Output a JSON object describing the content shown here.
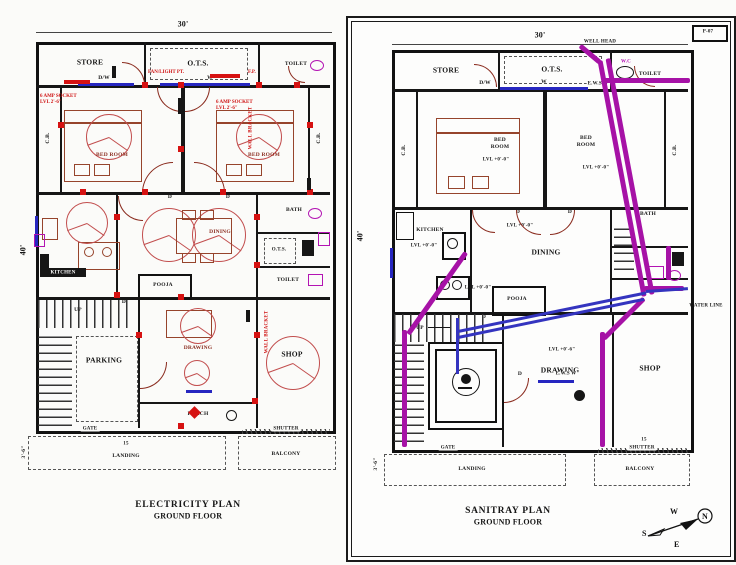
{
  "left_plan": {
    "title_line1": "ELECTRICITY PLAN",
    "title_line2": "GROUND FLOOR",
    "dim_top": "30'",
    "dim_side": "40'",
    "dim_bottom": "3'-6\"",
    "rooms": {
      "store": "STORE",
      "ots": "O.T.S.",
      "toilet_top": "TOILET",
      "bed_left": "BED ROOM",
      "bed_right": "BED ROOM",
      "cb_left": "C.B.",
      "cb_right": "C.B.",
      "kitchen": "KITCHEN",
      "dining": "DINING",
      "bath": "BATH",
      "ots_small": "O.T.S.",
      "toilet_mid": "TOILET",
      "pooja": "POOJA",
      "parking": "PARKING",
      "drawing_room": "DRAWING",
      "porch": "PORCH",
      "shop": "SHOP",
      "landing": "LANDING",
      "balcony": "BALCONY"
    },
    "tags": {
      "up": "UP",
      "gate": "GATE",
      "shutter": "SHUTTER",
      "dw": "D/W",
      "w": "W",
      "d": "D",
      "landing_width": "15"
    },
    "notes": {
      "fan_light": "FAN/LIGHT PT.",
      "fp": "F.P.",
      "socket_left": "6 AMP SOCKET\nLVL 2'-6\"",
      "socket_right": "6 AMP SOCKET\nLVL 2'-6\"",
      "wall_bracket_1": "WALL BRACKET",
      "wall_bracket_2": "WALL BRACKET"
    }
  },
  "right_plan": {
    "title_line1": "SANITRAY PLAN",
    "title_line2": "GROUND FLOOR",
    "sheet_no": "P-07",
    "dim_top": "30'",
    "dim_side": "40'",
    "dim_bottom": "3'-6\"",
    "rooms": {
      "store": "STORE",
      "ots": "O.T.S.",
      "toilet_top": "TOILET",
      "bed_left": "BED\nROOM",
      "bed_right": "BED\nROOM",
      "cb_left": "C.B.",
      "cb_right": "C.B.",
      "kitchen": "KITCHEN",
      "dining": "DINING",
      "bath": "BATH",
      "pooja": "POOJA",
      "drawing_room": "DRAWING",
      "shop": "SHOP",
      "landing": "LANDING",
      "balcony": "BALCONY"
    },
    "tags": {
      "up": "UP",
      "gate": "GATE",
      "shutter": "SHUTTER",
      "dw": "D/W",
      "w": "W",
      "d": "D",
      "shutter_width": "15"
    },
    "levels": {
      "ground": "LVL +0'-0\"",
      "drawing": "LVL +0'-6\""
    },
    "notes": {
      "well_head": "WELL HEAD",
      "wc": "W.C",
      "ews_top": "E.W.S W",
      "ews_drawing": "E.W.S W",
      "water_line": "WATER LINE"
    }
  },
  "compass": {
    "n": "N",
    "s": "S",
    "e": "E",
    "w": "W"
  },
  "colors": {
    "electrical": "#dd1111",
    "sanitary_pipe": "#a612a6",
    "window_line": "#2626c0",
    "furniture": "#96442c",
    "wall": "#111111"
  }
}
